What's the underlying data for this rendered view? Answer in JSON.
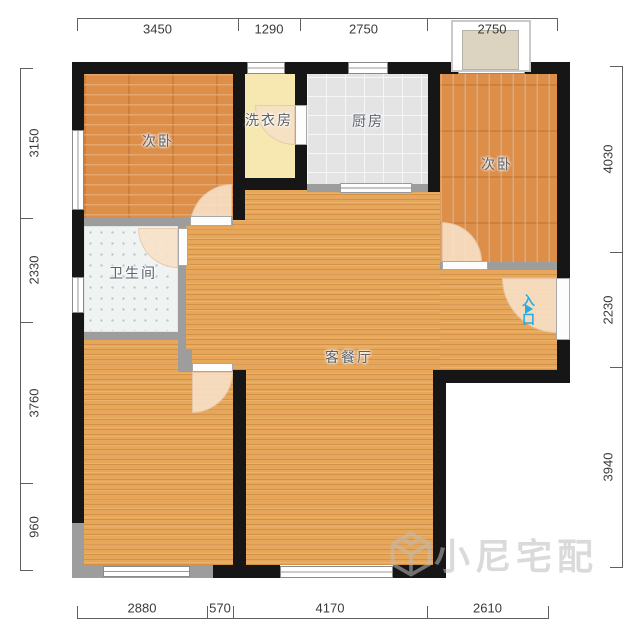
{
  "plan": {
    "width": 640,
    "height": 640,
    "background": "#ffffff"
  },
  "colors": {
    "wall": "#161616",
    "thin_wall": "#9d9d9d",
    "bedroom_floor": "#dd8e49",
    "living_floor": "#e7a75a",
    "kitchen_floor": "#e4e4e4",
    "laundry_floor": "#f6e8b0",
    "bathroom_floor": "#eff3f2",
    "door_swing": "#f7e0c6",
    "entrance_accent": "#29abe2",
    "dimension_text": "#3a3a3a",
    "watermark": "#bdbdbd"
  },
  "rooms": [
    {
      "name": "living-dining",
      "label": "客餐厅",
      "floor": "wood-light",
      "rects": [
        [
          186,
          185,
          260,
          380
        ],
        [
          440,
          190,
          117,
          180
        ]
      ],
      "label_pos": [
        349,
        357
      ]
    },
    {
      "name": "bedroom-bottom-left",
      "label": "",
      "floor": "wood-light",
      "rects": [
        [
          84,
          340,
          149,
          225
        ]
      ],
      "label_pos": null
    },
    {
      "name": "bedroom-top-left",
      "label": "次卧",
      "floor": "wood-h",
      "rects": [
        [
          84,
          74,
          149,
          152
        ]
      ],
      "label_pos": [
        158,
        141
      ]
    },
    {
      "name": "laundry",
      "label": "洗衣房",
      "floor": "laundry",
      "rects": [
        [
          245,
          74,
          50,
          104
        ]
      ],
      "label_pos": [
        269,
        120
      ]
    },
    {
      "name": "kitchen",
      "label": "厨房",
      "floor": "kitchen",
      "rects": [
        [
          307,
          74,
          121,
          118
        ]
      ],
      "label_pos": [
        368,
        121
      ]
    },
    {
      "name": "bedroom-top-right",
      "label": "次卧",
      "floor": "wood-v",
      "rects": [
        [
          440,
          74,
          117,
          196
        ]
      ],
      "label_pos": [
        497,
        164
      ]
    },
    {
      "name": "bathroom",
      "label": "卫生间",
      "floor": "bath",
      "rects": [
        [
          84,
          226,
          94,
          106
        ]
      ],
      "label_pos": [
        133,
        273
      ]
    }
  ],
  "door_fans": [
    {
      "rect": [
        190,
        184,
        42,
        42
      ],
      "corner": "tl"
    },
    {
      "rect": [
        138,
        228,
        40,
        40
      ],
      "corner": "bl"
    },
    {
      "rect": [
        255,
        105,
        40,
        40
      ],
      "corner": "bl"
    },
    {
      "rect": [
        442,
        222,
        40,
        40
      ],
      "corner": "tr"
    },
    {
      "rect": [
        502,
        278,
        55,
        55
      ],
      "corner": "bl"
    },
    {
      "rect": [
        192,
        372,
        41,
        41
      ],
      "corner": "br"
    }
  ],
  "thin_walls": [
    [
      84,
      218,
      149,
      8
    ],
    [
      178,
      226,
      8,
      137
    ],
    [
      84,
      332,
      94,
      8
    ],
    [
      178,
      350,
      14,
      22
    ],
    [
      307,
      184,
      121,
      8
    ],
    [
      440,
      262,
      117,
      8
    ],
    [
      72,
      523,
      12,
      42
    ],
    [
      72,
      565,
      141,
      13
    ],
    [
      437,
      565,
      9,
      13
    ]
  ],
  "walls": [
    [
      72,
      62,
      498,
      12
    ],
    [
      72,
      62,
      12,
      461
    ],
    [
      557,
      62,
      13,
      321
    ],
    [
      233,
      74,
      12,
      146
    ],
    [
      233,
      178,
      74,
      12
    ],
    [
      295,
      74,
      12,
      104
    ],
    [
      428,
      74,
      12,
      118
    ],
    [
      433,
      370,
      137,
      13
    ],
    [
      433,
      370,
      13,
      208
    ],
    [
      233,
      370,
      13,
      208
    ],
    [
      213,
      565,
      67,
      13
    ],
    [
      393,
      565,
      53,
      13
    ]
  ],
  "windows": [
    [
      72,
      130,
      12,
      80
    ],
    [
      72,
      277,
      12,
      36
    ],
    [
      247,
      62,
      38,
      12
    ],
    [
      348,
      62,
      40,
      12
    ],
    [
      458,
      62,
      67,
      12
    ],
    [
      103,
      566,
      87,
      11
    ],
    [
      280,
      566,
      113,
      12
    ]
  ],
  "doors": [
    [
      190,
      216,
      42,
      10
    ],
    [
      178,
      228,
      10,
      38
    ],
    [
      295,
      105,
      12,
      40
    ],
    [
      442,
      261,
      46,
      9
    ],
    [
      556,
      278,
      14,
      62
    ],
    [
      192,
      363,
      41,
      9
    ]
  ],
  "sliding_doors": [
    [
      340,
      183,
      72,
      10
    ]
  ],
  "platform": {
    "outer": [
      451,
      20,
      80,
      52
    ],
    "inner": [
      462,
      30,
      57,
      40
    ]
  },
  "entrance": {
    "label": "入口"
  },
  "watermark": {
    "text": "小尼宅配"
  },
  "dimensions": {
    "top": {
      "orientation": "h",
      "line": 18,
      "ticks": [
        77,
        238,
        300,
        427,
        557
      ],
      "values": [
        "3450",
        "1290",
        "2750",
        "2750"
      ],
      "label_side": "below"
    },
    "bottom": {
      "orientation": "h",
      "line": 618,
      "ticks": [
        77,
        207,
        233,
        427,
        548
      ],
      "values": [
        "2880",
        "570",
        "4170",
        "2610"
      ],
      "label_side": "above"
    },
    "left": {
      "orientation": "v",
      "line": 20,
      "ticks": [
        68,
        218,
        322,
        483,
        570
      ],
      "values": [
        "3150",
        "2330",
        "3760",
        "960"
      ],
      "label_side": "right"
    },
    "right": {
      "orientation": "v",
      "line": 622,
      "ticks": [
        66,
        252,
        367,
        567
      ],
      "values": [
        "4030",
        "2230",
        "3940"
      ],
      "label_side": "left"
    }
  }
}
